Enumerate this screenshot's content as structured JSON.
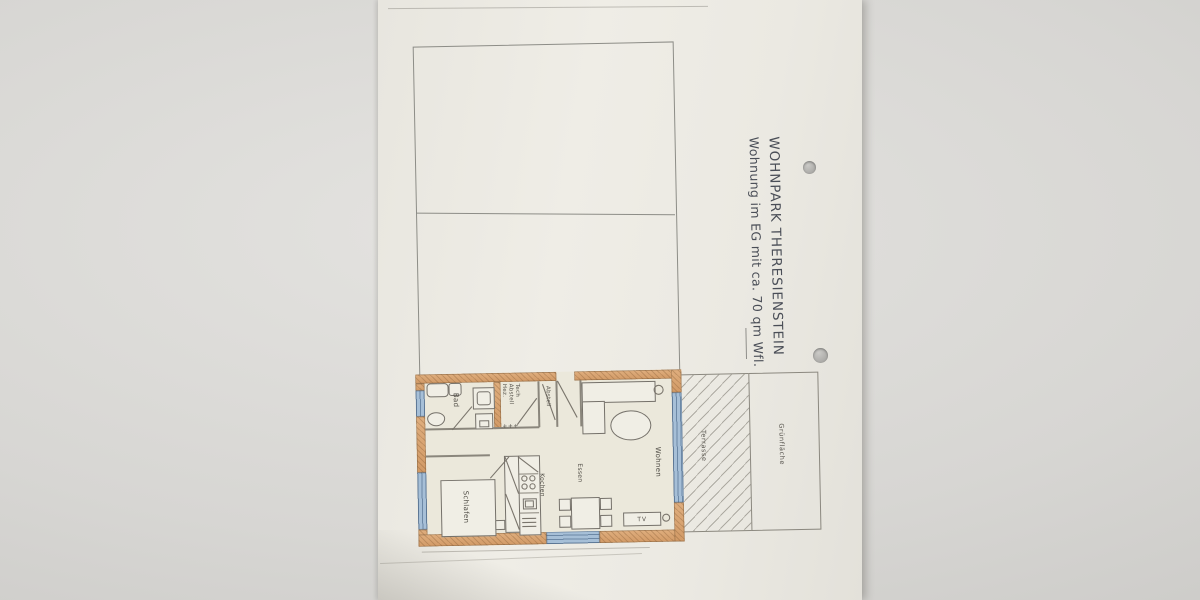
{
  "colors": {
    "paper": "#efede6",
    "background_gray": "#d7d6d3",
    "wall_fill": "#d7a271",
    "window_fill": "#a6bfd7",
    "pencil_line": "#8a867c",
    "title_ink": "#4a4e57"
  },
  "title_block": {
    "line1": "WOHNPARK THERESIENSTEIN",
    "line2": "Wohnung im EG mit ca. 70 qm Wfl."
  },
  "floor_plan": {
    "rooms": {
      "bad": "Bad",
      "technik": [
        "Hez.",
        "Abstell",
        "Tech"
      ],
      "abstell": "Abstell",
      "schlafen": "Schlafen",
      "kochen": "Kochen",
      "essen": "Essen",
      "wohnen": "Wohnen"
    },
    "furniture": {
      "tv": "TV"
    },
    "symbols": {
      "radiator": "+++"
    },
    "outdoor": {
      "terrasse": "Terrasse",
      "gruenflaeche": "Grünfläche"
    }
  }
}
